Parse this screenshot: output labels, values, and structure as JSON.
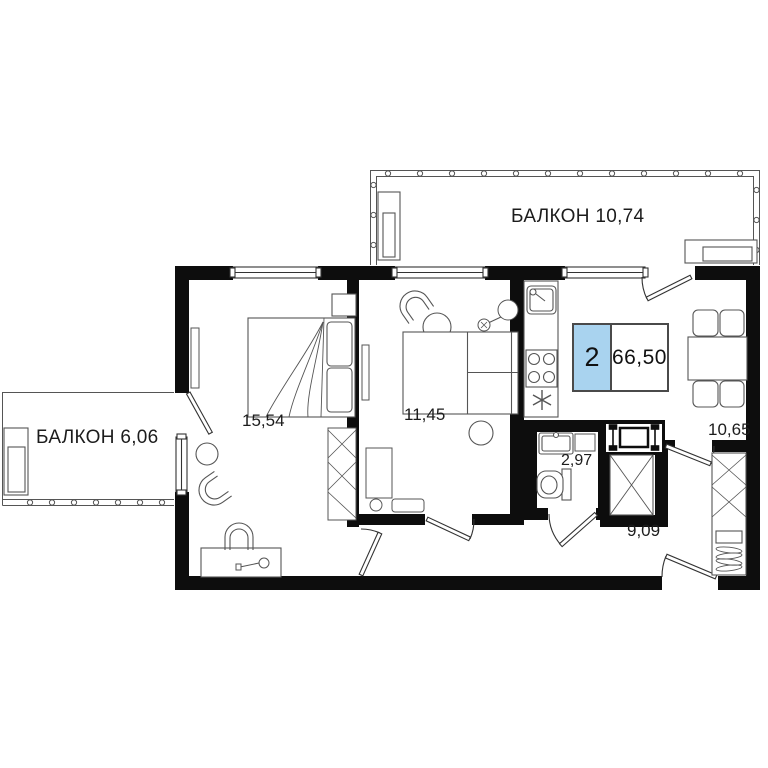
{
  "plan": {
    "type": "apartment-floor-plan",
    "badge": {
      "room_count": "2",
      "total_area": "66,50",
      "accent_color": "#a9d3ef"
    },
    "labels": {
      "balcony_top": "БАЛКОН 10,74",
      "balcony_left": "БАЛКОН 6,06",
      "bedroom_area": "15,54",
      "living_room_area": "11,45",
      "bathroom_area": "2,97",
      "hallway_area": "9,09",
      "dining_area": "10,65"
    },
    "colors": {
      "wall": "#0d0d0d",
      "line": "#555555",
      "badge_border": "#4a4a4a"
    }
  }
}
